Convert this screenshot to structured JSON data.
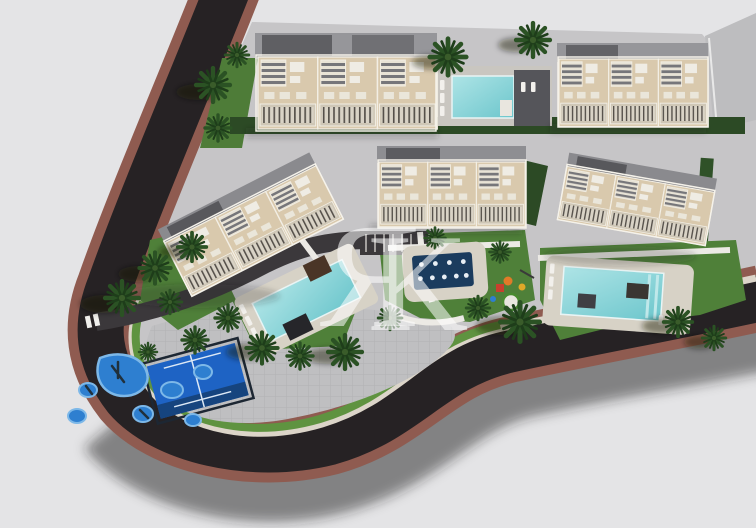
{
  "image_kind": "aerial-3d-render-residential-complex",
  "watermark": {
    "letter_r": "R",
    "letter_k": "K",
    "color": "#ffffff"
  },
  "palette": {
    "background": "#e4e4e6",
    "road_asphalt": "#262224",
    "road_sidewalk_brown": "#8f5b50",
    "curb_beige": "#dcd5c9",
    "paver_gray": "#c6c5c7",
    "lawn_green": "#4f8039",
    "hedge_green": "#2c4a25",
    "building_facade": "#d9c9ad",
    "building_trim": "#f2eee4",
    "roof_gray": "#96969a",
    "roof_dark": "#5f5f63",
    "pool_water": "#8fd6d8",
    "pool_deck": "#d7d2c6",
    "splash_pad_navy": "#1b3c5e",
    "sport_court_blue": "#1e63c4",
    "play_mat_blue": "#2e7fd0",
    "palm_green": "#2b5224"
  },
  "features": {
    "buildings": 5,
    "swimming_pools": 3,
    "splash_pad": 1,
    "sport_court": 1,
    "playgrounds": 2
  }
}
